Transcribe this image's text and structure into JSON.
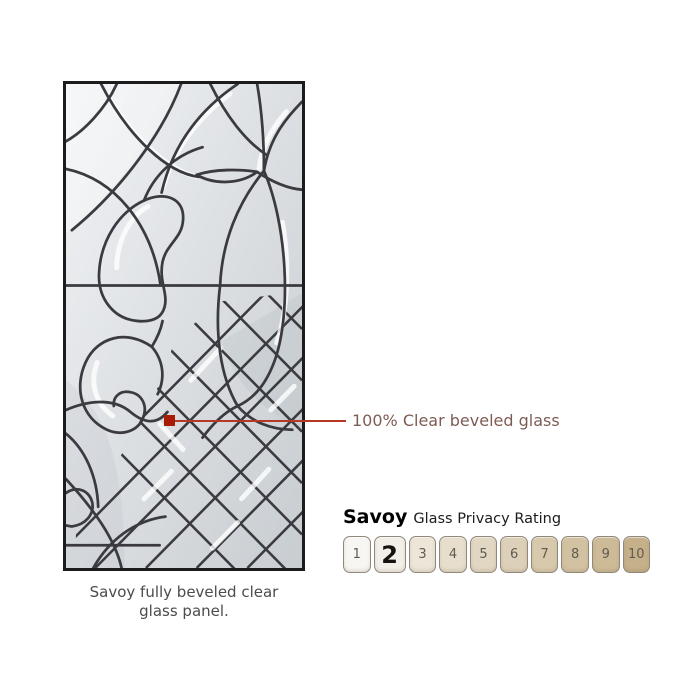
{
  "panel": {
    "caption": "Savoy fully beveled clear glass panel.",
    "glass": {
      "background_light": "#eff1f3",
      "background_dark": "#c8cdd1",
      "caming_color": "#3a3a40",
      "frame_color": "#1c1c1c",
      "bevel_highlight": "#ffffff"
    }
  },
  "annotation": {
    "label": "100% Clear beveled glass",
    "marker_color": "#a81c06",
    "line_color": "#b33a24",
    "text_color": "#7e5c54"
  },
  "rating": {
    "title": "Savoy",
    "subtitle": "Glass Privacy Rating",
    "selected_value": "2",
    "levels": [
      {
        "value": "1",
        "color": "#f7f6f2"
      },
      {
        "value": "2",
        "color": "#f2efe8",
        "selected": true
      },
      {
        "value": "3",
        "color": "#ece5d8"
      },
      {
        "value": "4",
        "color": "#e7decd"
      },
      {
        "value": "5",
        "color": "#e2d7c3"
      },
      {
        "value": "6",
        "color": "#ddd0b8"
      },
      {
        "value": "7",
        "color": "#d8c9ad"
      },
      {
        "value": "8",
        "color": "#d3c2a2"
      },
      {
        "value": "9",
        "color": "#cdba96"
      },
      {
        "value": "10",
        "color": "#c6b089"
      }
    ]
  }
}
